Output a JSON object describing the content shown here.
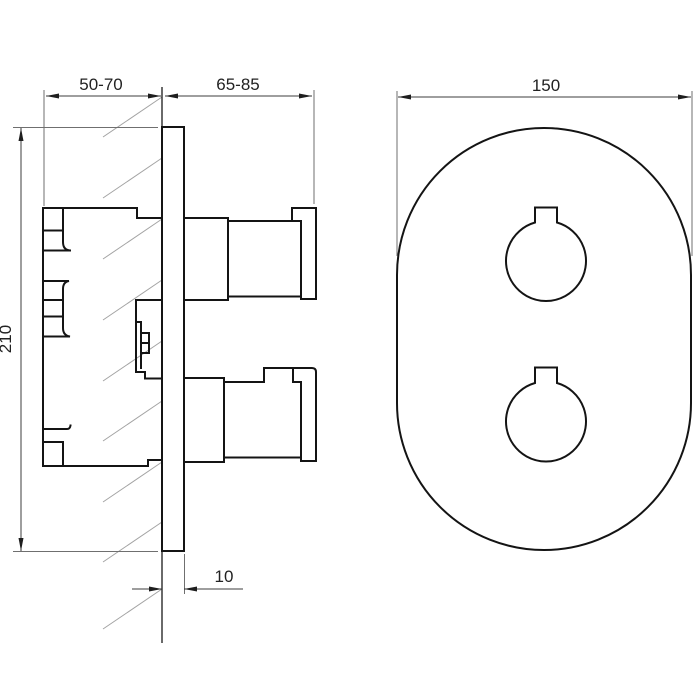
{
  "page": {
    "background": "#ffffff",
    "ink": "#141414",
    "hatch_color": "#a3a3a3"
  },
  "drawing": {
    "kind": "technical installation drawing",
    "subject": "concealed thermostatic mixer: side section view with wall and front view of oval trim plate with two knobs",
    "views": [
      {
        "id": "side",
        "name": "side section view"
      },
      {
        "id": "front",
        "name": "front view"
      }
    ],
    "labels": {
      "recess_depth": "50-70",
      "protrusion": "65-85",
      "plate_width": "150",
      "plate_height": "210",
      "plate_thickness": "10"
    }
  }
}
